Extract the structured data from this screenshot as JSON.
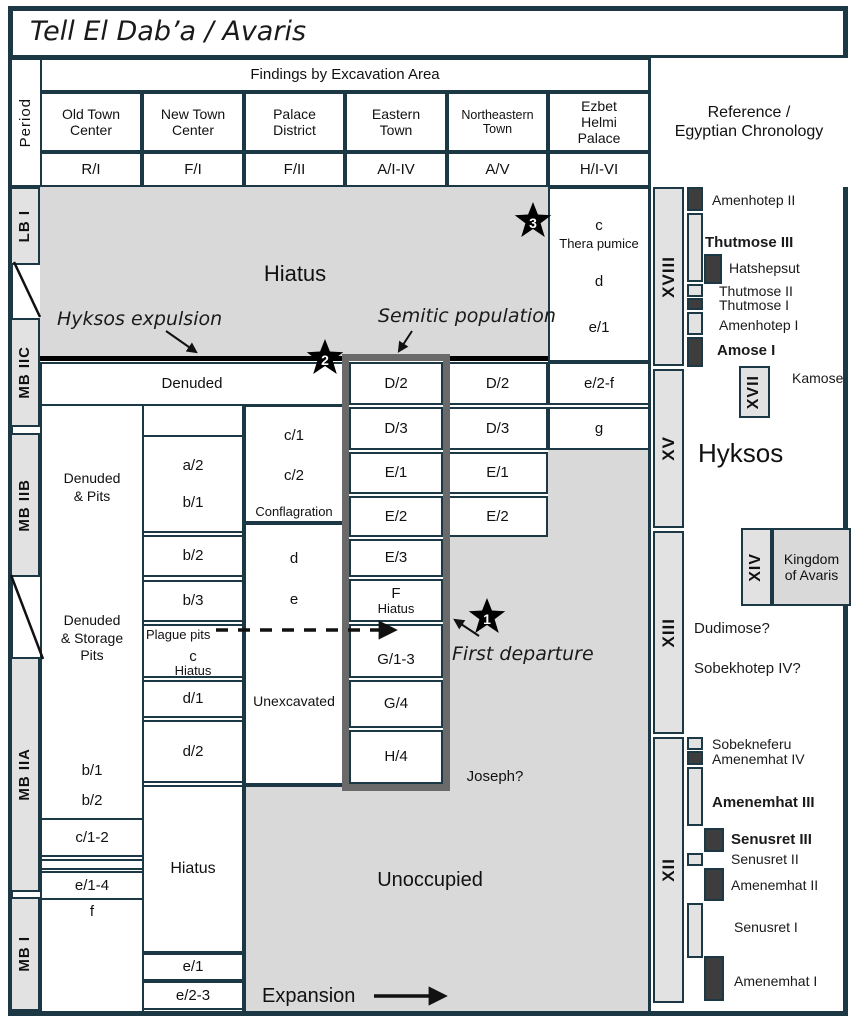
{
  "title": "Tell El Dab’a / Avaris",
  "header": {
    "period_label": "Period",
    "findings_label": "Findings by Excavation Area",
    "reference_label": "Reference /\nEgyptian Chronology",
    "columns": [
      {
        "name": "Old Town\nCenter",
        "code": "R/I"
      },
      {
        "name": "New Town\nCenter",
        "code": "F/I"
      },
      {
        "name": "Palace\nDistrict",
        "code": "F/II"
      },
      {
        "name": "Eastern\nTown",
        "code": "A/I-IV"
      },
      {
        "name": "Northeastern\nTown",
        "code": "A/V"
      },
      {
        "name": "Ezbet\nHelmi\nPalace",
        "code": "H/I-VI"
      }
    ]
  },
  "periods": [
    "LB I",
    "MB IIC",
    "MB IIB",
    "MB IIA",
    "MB I"
  ],
  "annotations": {
    "hiatus_top": "Hiatus",
    "hyksos_expulsion": "Hyksos expulsion",
    "semitic_population": "Semitic population",
    "first_departure": "First departure",
    "joseph": "Joseph?",
    "unoccupied": "Unoccupied",
    "expansion": "Expansion",
    "denuded": "Denuded"
  },
  "stars": [
    "1",
    "2",
    "3"
  ],
  "strata": {
    "old_town": {
      "denuded_pits": "Denuded\n& Pits",
      "denuded_storage_pits": "Denuded\n& Storage\nPits",
      "b1": "b/1",
      "b2": "b/2",
      "c12": "c/1-2",
      "e14": "e/1-4",
      "f": "f"
    },
    "new_town": {
      "a2": "a/2",
      "b1": "b/1",
      "b2": "b/2",
      "b3": "b/3",
      "plague_pits": "Plague pits",
      "c": "c",
      "c_hiatus": "Hiatus",
      "d1": "d/1",
      "d2": "d/2",
      "hiatus": "Hiatus",
      "e1": "e/1",
      "e23": "e/2-3"
    },
    "palace": {
      "c1": "c/1",
      "c2": "c/2",
      "conflagration": "Conflagration",
      "d": "d",
      "e": "e",
      "unexcavated": "Unexcavated"
    },
    "eastern": {
      "d2": "D/2",
      "d3": "D/3",
      "e1": "E/1",
      "e2": "E/2",
      "e3": "E/3",
      "f": "F",
      "f_hiatus": "Hiatus",
      "g13": "G/1-3",
      "g4": "G/4",
      "h4": "H/4"
    },
    "northeastern": {
      "d2": "D/2",
      "d3": "D/3",
      "e1": "E/1",
      "e2": "E/2"
    },
    "ezbet": {
      "c": "c",
      "thera": "Thera pumice",
      "d": "d",
      "e1": "e/1",
      "e2f": "e/2-f",
      "g": "g"
    }
  },
  "chronology": {
    "dyn18": "XVIII",
    "dyn17": "XVII",
    "dyn15": "XV",
    "dyn14": "XIV",
    "dyn13": "XIII",
    "dyn12": "XII",
    "hyksos": "Hyksos",
    "kamose": "Kamose",
    "kingdom_of_avaris": "Kingdom\nof Avaris",
    "dyn18_pharaohs": [
      "Amenhotep II",
      "Thutmose III",
      "Hatshepsut",
      "Thutmose II",
      "Thutmose I",
      "Amenhotep I",
      "Amose I"
    ],
    "dyn13_pharaohs": [
      "Dudimose?",
      "Sobekhotep IV?"
    ],
    "dyn12_pharaohs": [
      "Sobekneferu",
      "Amenemhat IV",
      "Amenemhat III",
      "Senusret III",
      "Senusret II",
      "Amenemhat II",
      "Senusret I",
      "Amenemhat I"
    ]
  },
  "colors": {
    "grid_border": "#1c3844",
    "gray_fill": "#d9d9d9",
    "bar_fill": "#e2e2e2",
    "thick_frame": "#6a6a6a",
    "dark_tick": "#3d3d3d",
    "expulsion_line": "#000000"
  }
}
